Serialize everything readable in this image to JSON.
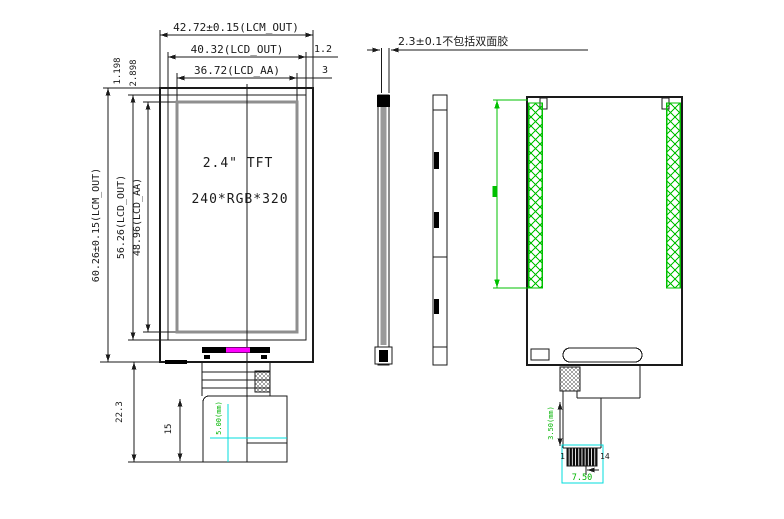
{
  "colors": {
    "line": "#1a1a1a",
    "aa_border": "#8f8f8f",
    "tape_green": "#00c000",
    "annotation_green": "#00b400",
    "magenta": "#ff00ff",
    "cyan": "#00dcdc",
    "background": "#ffffff"
  },
  "front_view": {
    "width_dims": {
      "lcm": "42.72±0.15(LCM_OUT)",
      "lcd": "40.32(LCD_OUT)",
      "aa": "36.72(LCD_AA)",
      "edge_gap": "1.2",
      "aa_gap": "3"
    },
    "height_dims": {
      "lcm": "60.26±0.15(LCM_OUT)",
      "lcd": "56.26(LCD_OUT)",
      "aa": "48.96(LCD_AA)",
      "top_gap_lcd": "1.198",
      "top_gap_aa": "2.898"
    },
    "fpc_dims": {
      "length": "22.3",
      "fold": "15",
      "width_note": "5.00(mm)"
    },
    "labels": {
      "size": "2.4\" TFT",
      "resolution": "240*RGB*320"
    }
  },
  "side_view": {
    "thickness_note": "2.3±0.1不包括双面胶"
  },
  "back_view": {
    "fpc": {
      "stiffener_note": "3.50(mm)",
      "connector_width": "7.50",
      "pin_first": "1",
      "pin_last": "14"
    }
  }
}
